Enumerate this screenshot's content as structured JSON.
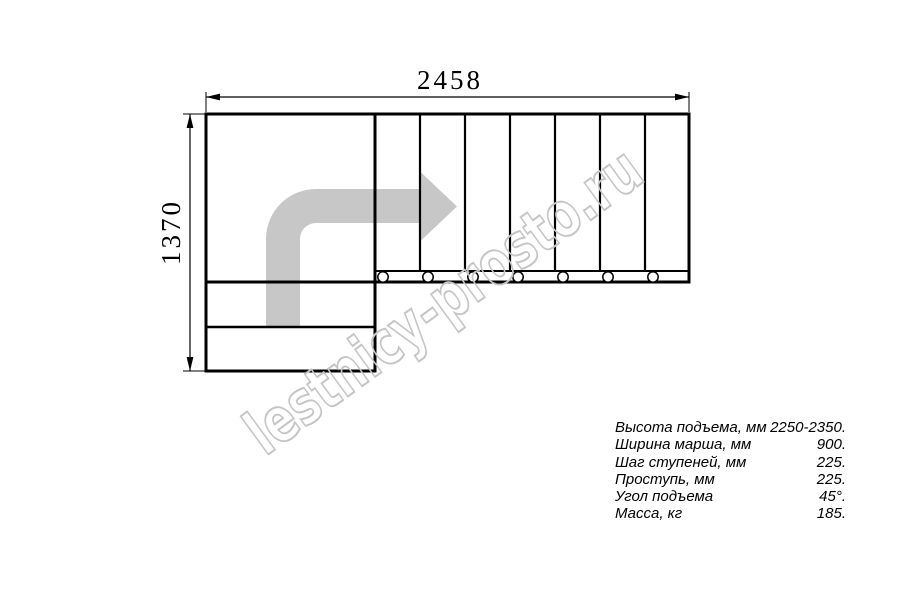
{
  "drawing": {
    "dim_width": "2458",
    "dim_height": "1370",
    "tread_count": 7,
    "colors": {
      "line": "#000000",
      "arrow": "#c7c7c7",
      "watermark": "#c5c5c5"
    }
  },
  "watermark": {
    "text": "lestnicy-prosto.ru"
  },
  "specs": {
    "rows": [
      {
        "label": "Высота подъема, мм",
        "value": "2250-2350."
      },
      {
        "label": "Ширина марша, мм",
        "value": "900."
      },
      {
        "label": "Шаг ступеней, мм",
        "value": "225."
      },
      {
        "label": "Проступь, мм",
        "value": "225."
      },
      {
        "label": "Угол подъема",
        "value": "45°."
      },
      {
        "label": "Масса, кг",
        "value": "185."
      }
    ]
  }
}
